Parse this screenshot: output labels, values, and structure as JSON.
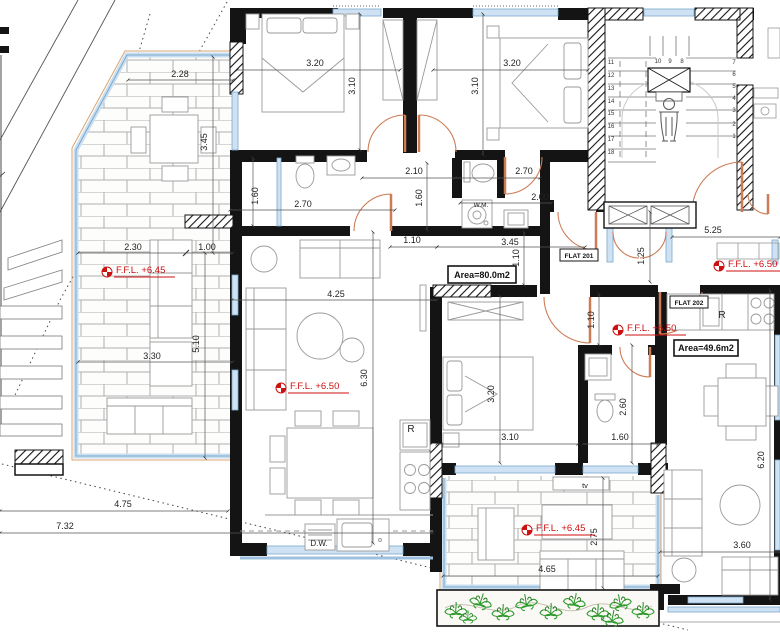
{
  "flats": {
    "f201": {
      "name": "FLAT 201",
      "area": "Area=80.0m2"
    },
    "f202": {
      "name": "FLAT 202",
      "area": "Area=49.6m2"
    }
  },
  "level_markers": [
    {
      "text": "F.F.L. +6.45",
      "x": 107,
      "y": 272
    },
    {
      "text": "F.F.L. +6.50",
      "x": 281,
      "y": 388
    },
    {
      "text": "F.F.L. +6.50",
      "x": 719,
      "y": 266
    },
    {
      "text": "F.F.L. +6.50",
      "x": 618,
      "y": 330
    },
    {
      "text": "F.F.L. +6.45",
      "x": 527,
      "y": 530
    }
  ],
  "dimensions": [
    {
      "text": "2.28",
      "x": 180,
      "y": 77,
      "rot": 0
    },
    {
      "text": "3.45",
      "x": 207,
      "y": 142,
      "rot": -90
    },
    {
      "text": "3.20",
      "x": 315,
      "y": 66,
      "rot": 0
    },
    {
      "text": "3.10",
      "x": 355,
      "y": 86,
      "rot": -90
    },
    {
      "text": "3.20",
      "x": 512,
      "y": 66,
      "rot": 0
    },
    {
      "text": "3.10",
      "x": 478,
      "y": 86,
      "rot": -90
    },
    {
      "text": "2.70",
      "x": 303,
      "y": 207,
      "rot": 0
    },
    {
      "text": "1.60",
      "x": 258,
      "y": 196,
      "rot": -90
    },
    {
      "text": "2.10",
      "x": 414,
      "y": 174,
      "rot": 0
    },
    {
      "text": "1.60",
      "x": 422,
      "y": 198,
      "rot": -90
    },
    {
      "text": "2.70",
      "x": 524,
      "y": 174,
      "rot": 0
    },
    {
      "text": "2.00",
      "x": 540,
      "y": 200,
      "rot": 0
    },
    {
      "text": "3.45",
      "x": 510,
      "y": 245,
      "rot": 0
    },
    {
      "text": "1.10",
      "x": 412,
      "y": 243,
      "rot": 0
    },
    {
      "text": "2.30",
      "x": 133,
      "y": 250,
      "rot": 0
    },
    {
      "text": "1.00",
      "x": 207,
      "y": 250,
      "rot": 0
    },
    {
      "text": "3.30",
      "x": 152,
      "y": 359,
      "rot": 0
    },
    {
      "text": "5.10",
      "x": 199,
      "y": 344,
      "rot": -90
    },
    {
      "text": "4.25",
      "x": 336,
      "y": 297,
      "rot": 0
    },
    {
      "text": "6.30",
      "x": 367,
      "y": 378,
      "rot": -90
    },
    {
      "text": "1.10",
      "x": 519,
      "y": 258,
      "rot": -90
    },
    {
      "text": "1.10",
      "x": 594,
      "y": 320,
      "rot": -90
    },
    {
      "text": "5.25",
      "x": 713,
      "y": 233,
      "rot": 0
    },
    {
      "text": "1.25",
      "x": 644,
      "y": 256,
      "rot": -90
    },
    {
      "text": "3.20",
      "x": 494,
      "y": 394,
      "rot": -90
    },
    {
      "text": "3.10",
      "x": 510,
      "y": 440,
      "rot": 0
    },
    {
      "text": "2.60",
      "x": 626,
      "y": 407,
      "rot": -90
    },
    {
      "text": "1.60",
      "x": 620,
      "y": 440,
      "rot": 0
    },
    {
      "text": "6.20",
      "x": 764,
      "y": 460,
      "rot": -90
    },
    {
      "text": "3.60",
      "x": 742,
      "y": 548,
      "rot": 0
    },
    {
      "text": "4.75",
      "x": 123,
      "y": 507,
      "rot": 0
    },
    {
      "text": "7.32",
      "x": 65,
      "y": 529,
      "rot": 0
    },
    {
      "text": "4.65",
      "x": 547,
      "y": 572,
      "rot": 0
    },
    {
      "text": "2.75",
      "x": 597,
      "y": 537,
      "rot": -90
    }
  ],
  "stair_numbers": [
    {
      "text": "11",
      "x": 611,
      "y": 64
    },
    {
      "text": "12",
      "x": 611,
      "y": 77
    },
    {
      "text": "13",
      "x": 611,
      "y": 90
    },
    {
      "text": "14",
      "x": 611,
      "y": 103
    },
    {
      "text": "15",
      "x": 611,
      "y": 115
    },
    {
      "text": "16",
      "x": 611,
      "y": 128
    },
    {
      "text": "17",
      "x": 611,
      "y": 141
    },
    {
      "text": "18",
      "x": 611,
      "y": 154
    },
    {
      "text": "10",
      "x": 658,
      "y": 63
    },
    {
      "text": "9",
      "x": 670,
      "y": 63
    },
    {
      "text": "8",
      "x": 682,
      "y": 63
    },
    {
      "text": "7",
      "x": 734,
      "y": 64
    },
    {
      "text": "6",
      "x": 734,
      "y": 76
    },
    {
      "text": "5",
      "x": 734,
      "y": 88
    },
    {
      "text": "4",
      "x": 734,
      "y": 100
    },
    {
      "text": "3",
      "x": 734,
      "y": 112
    },
    {
      "text": "2",
      "x": 734,
      "y": 126
    },
    {
      "text": "1",
      "x": 734,
      "y": 138
    }
  ],
  "appliance_labels": [
    {
      "text": "W.M.",
      "x": 481,
      "y": 207,
      "size": 6.5
    },
    {
      "text": "D.W.",
      "x": 319,
      "y": 546,
      "size": 8
    },
    {
      "text": "R",
      "x": 411,
      "y": 432,
      "size": 10
    },
    {
      "text": "R",
      "x": 722,
      "y": 318,
      "size": 10
    },
    {
      "text": "tv",
      "x": 585,
      "y": 488,
      "size": 7.5
    }
  ],
  "colors": {
    "wall": "#141414",
    "door": "#cd7c55",
    "glass": "#7aa9cc",
    "glass_fill": "#cfe2f3",
    "level_red": "#cc1111",
    "brick_line": "#b0b0b0",
    "furniture": "#9a9a9a",
    "plant_green": "#2f9b2f"
  }
}
